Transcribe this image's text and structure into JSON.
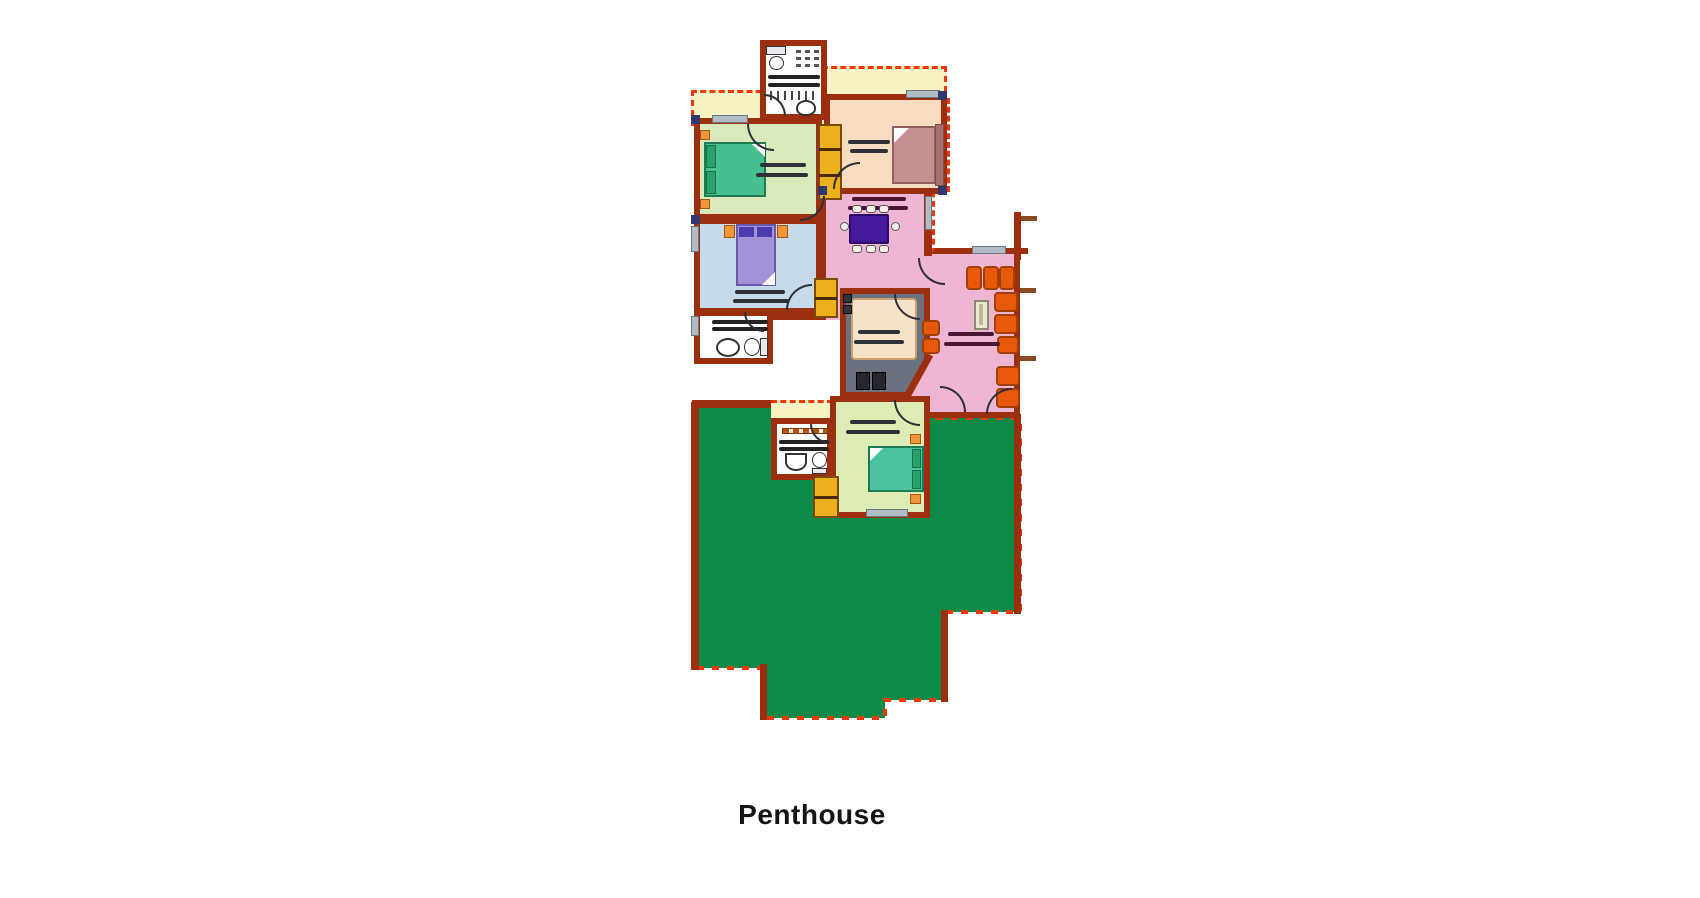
{
  "title": {
    "label": "Penthouse"
  },
  "colors": {
    "wall": "#9c2f10",
    "dash": "#e8380d",
    "terrace": "#0c8a47",
    "pale": "#f8f3c4",
    "green_room": "#d8e9bb",
    "blue_room": "#c6daea",
    "peach_room": "#f8dcc1",
    "pink_room": "#efb6d3",
    "kitchen": "#6a7280",
    "island": "#f6e2c9",
    "green2": "#dcecb4",
    "gold": "#edb01d",
    "teal": "#47c091",
    "teal_dark": "#2aa06b",
    "purple_bed": "#a392d8",
    "purple_dark": "#4a3cae",
    "mauve": "#c68f8f",
    "mauve_dark": "#a87070",
    "table": "#45189c",
    "sofa": "#e8590c",
    "sofa_dark": "#a33e04",
    "window": "#b2bcc4",
    "rug": "#2f2f38",
    "accent": "#f0953a",
    "navy": "#31386e"
  }
}
